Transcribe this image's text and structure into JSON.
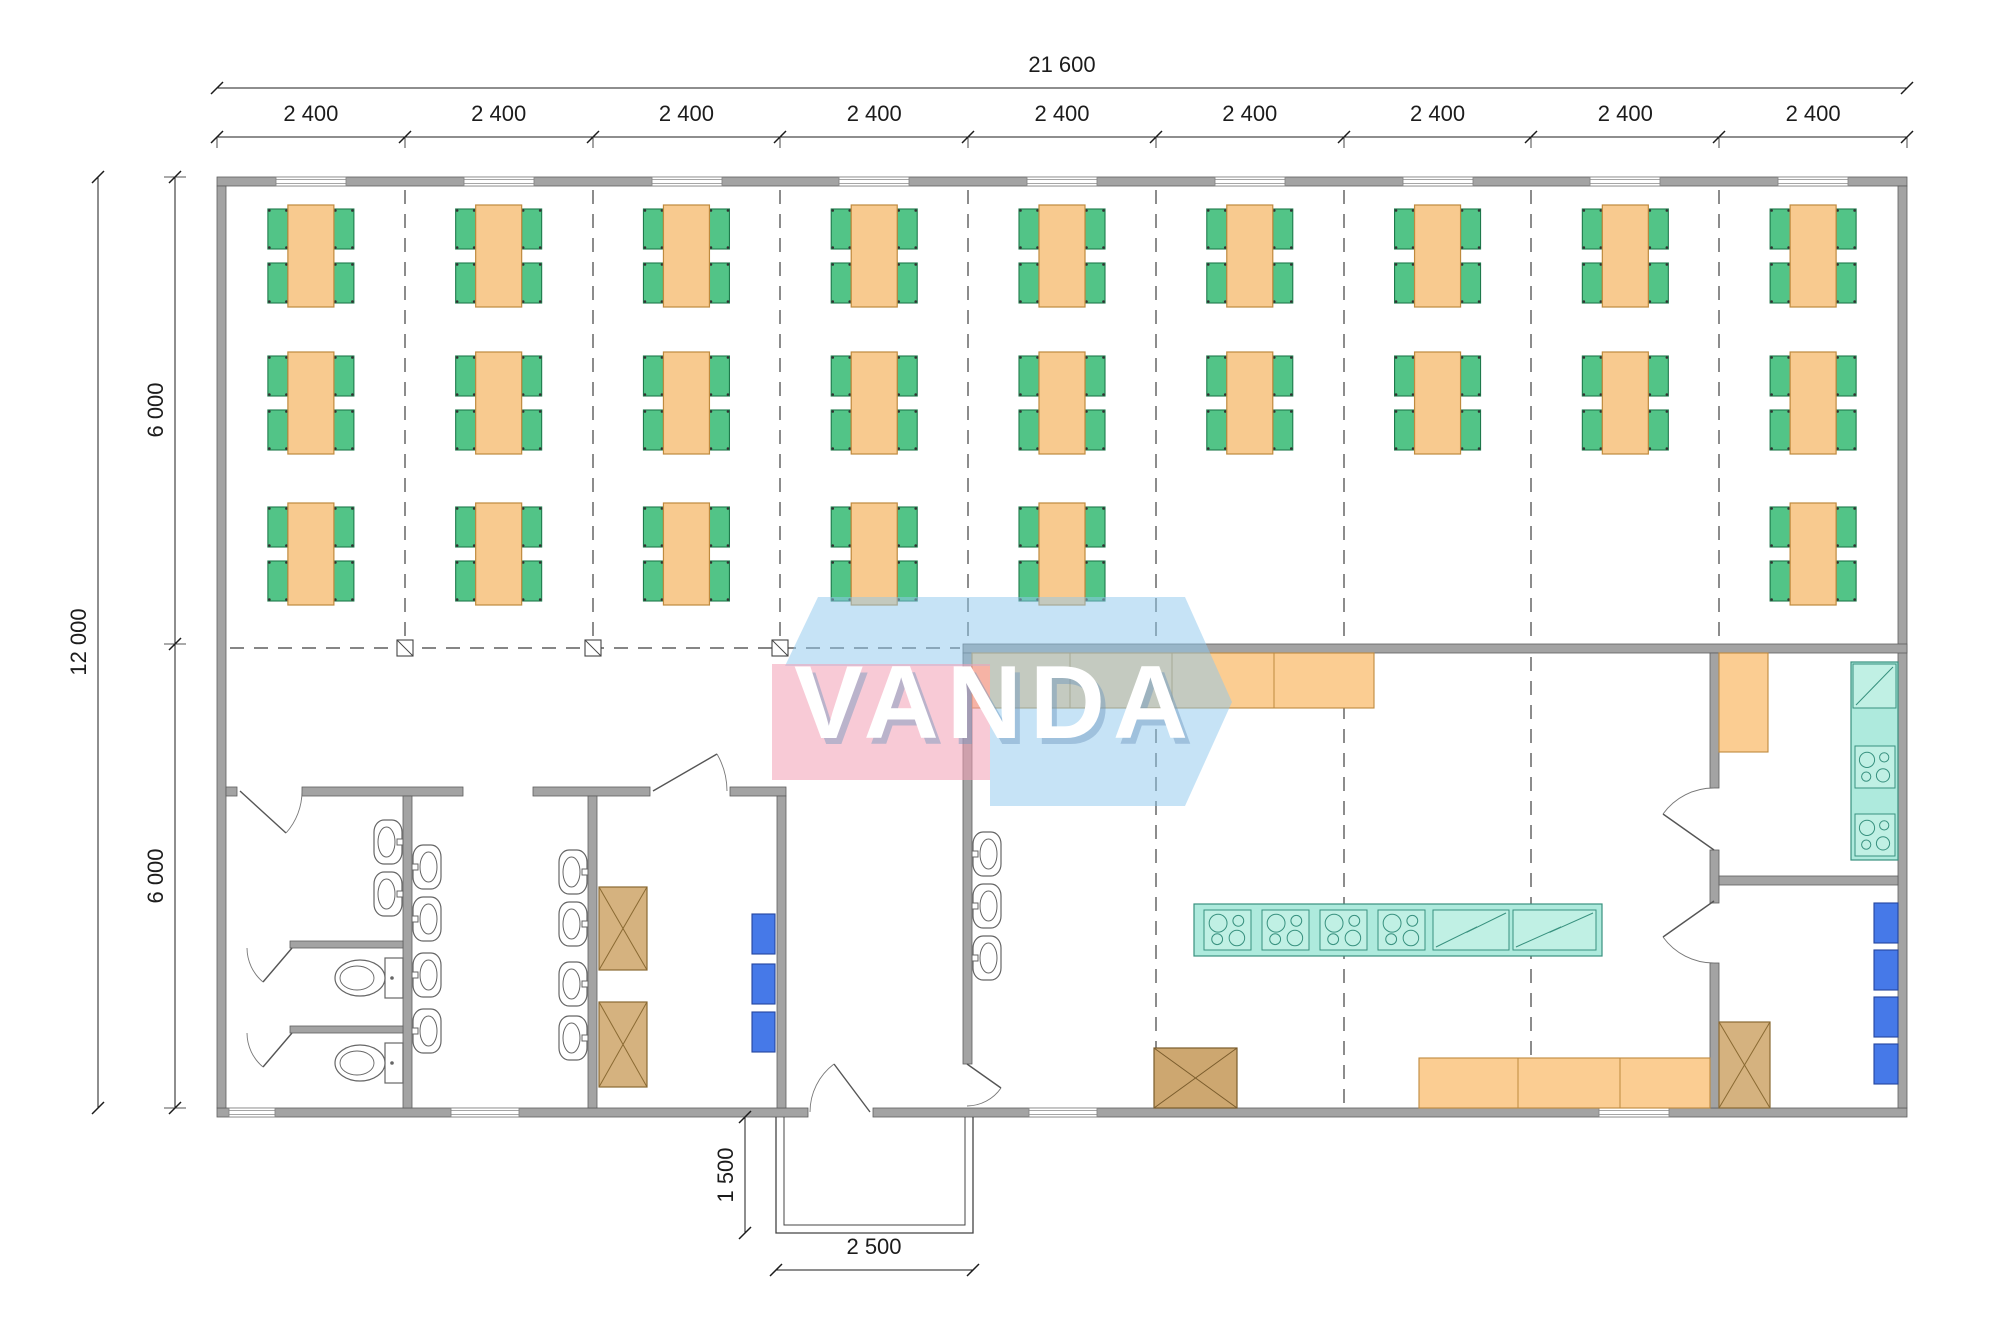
{
  "watermark": {
    "text": "VANDA",
    "pink": "rgba(242,158,180,0.55)",
    "blue": "rgba(141,200,238,0.50)",
    "text_color": "#ffffff",
    "shadow_color": "rgba(110,150,190,0.45)"
  },
  "labels": {
    "overall_width": "21 600",
    "bay": "2 400",
    "overall_height": "12 000",
    "half_height": "6 000",
    "porch_depth": "1 500",
    "porch_width": "2 500"
  },
  "colors": {
    "wall_fill": "#a3a3a3",
    "wall_edge": "#5e5e5e",
    "dim": "#1c1c1c",
    "dash": "#3f3f3f",
    "table_fill": "#f8ca8f",
    "table_edge": "#bf8a3e",
    "chair_fill": "#52c487",
    "chair_edge": "#1e7a4c",
    "counter_fill": "#fbcd92",
    "counter_edge": "#bf8a3e",
    "teal_fill": "#aeeadd",
    "teal_unit": "#c0f0e4",
    "teal_edge": "#38917f",
    "tan_fill": "#d5b27f",
    "tan_edge": "#8a6a33",
    "brown_fill": "#cda770",
    "brown_edge": "#7a5c2c",
    "blue_fill": "#4679e8",
    "blue_edge": "#24459e",
    "fixture_edge": "#666666",
    "porch_edge": "#444444",
    "window_edge": "#888888"
  },
  "geometry": {
    "bounds": {
      "x1": 217,
      "y1": 177,
      "x2": 1907,
      "y2": 1117
    },
    "bay_count": 9,
    "walls": [
      [
        217,
        177,
        1690,
        9
      ],
      [
        217,
        1108,
        591,
        9
      ],
      [
        873,
        1108,
        1034,
        9
      ],
      [
        217,
        186,
        9,
        922
      ],
      [
        1898,
        186,
        9,
        922
      ],
      [
        963,
        644,
        944,
        9
      ],
      [
        226,
        787,
        11,
        9
      ],
      [
        302,
        787,
        161,
        9
      ],
      [
        533,
        787,
        117,
        9
      ],
      [
        730,
        787,
        56,
        9
      ],
      [
        403,
        796,
        9,
        312
      ],
      [
        588,
        796,
        9,
        312
      ],
      [
        777,
        796,
        9,
        312
      ],
      [
        963,
        653,
        9,
        411
      ],
      [
        1710,
        653,
        9,
        135
      ],
      [
        1710,
        850,
        9,
        53
      ],
      [
        1710,
        963,
        9,
        145
      ],
      [
        1719,
        876,
        179,
        9
      ],
      [
        290,
        941,
        113,
        7
      ],
      [
        290,
        1026,
        113,
        7
      ]
    ],
    "windows_top": {
      "y": 177,
      "h": 9,
      "w": 70,
      "centers": [
        311,
        499,
        687,
        874,
        1062,
        1250,
        1438,
        1625,
        1813
      ]
    },
    "windows_bottom": {
      "y": 1108,
      "h": 9,
      "items": [
        [
          229,
          46
        ],
        [
          451,
          68
        ],
        [
          1029,
          68
        ],
        [
          1599,
          70
        ]
      ]
    },
    "doors": [
      {
        "h": [
          240,
          791
        ],
        "t": [
          286,
          833
        ],
        "a": [
          302,
          791
        ],
        "sweep": 0
      },
      {
        "h": [
          653,
          791
        ],
        "t": [
          717,
          754
        ],
        "a": [
          727,
          791
        ],
        "sweep": 1
      },
      {
        "h": [
          870,
          1112
        ],
        "t": [
          834,
          1064
        ],
        "a": [
          810,
          1112
        ],
        "sweep": 0
      },
      {
        "h": [
          967,
          1064
        ],
        "t": [
          1001,
          1088
        ],
        "a": [
          967,
          1106
        ],
        "sweep": 1
      },
      {
        "h": [
          1714,
          850
        ],
        "t": [
          1663,
          814
        ],
        "a": [
          1714,
          788
        ],
        "sweep": 1
      },
      {
        "h": [
          1714,
          901
        ],
        "t": [
          1663,
          937
        ],
        "a": [
          1714,
          963
        ],
        "sweep": 0
      },
      {
        "h": [
          292,
          948
        ],
        "t": [
          263,
          982
        ],
        "a": [
          247,
          948
        ],
        "sweep": 1
      },
      {
        "h": [
          292,
          1033
        ],
        "t": [
          263,
          1067
        ],
        "a": [
          247,
          1033
        ],
        "sweep": 1
      }
    ],
    "dash_v": [
      {
        "x": 405,
        "y1": 190,
        "y2": 640
      },
      {
        "x": 593,
        "y1": 190,
        "y2": 640
      },
      {
        "x": 780,
        "y1": 190,
        "y2": 640
      },
      {
        "x": 968,
        "y1": 190,
        "y2": 640
      },
      {
        "x": 1156,
        "y1": 190,
        "y2": 640
      },
      {
        "x": 1344,
        "y1": 190,
        "y2": 640
      },
      {
        "x": 1531,
        "y1": 190,
        "y2": 640
      },
      {
        "x": 1719,
        "y1": 190,
        "y2": 640
      },
      {
        "x": 1156,
        "y1": 657,
        "y2": 1104
      },
      {
        "x": 1344,
        "y1": 657,
        "y2": 1104
      },
      {
        "x": 1531,
        "y1": 657,
        "y2": 1104
      }
    ],
    "dash_h": [
      {
        "y": 648,
        "x1": 230,
        "x2": 960
      }
    ],
    "columns": [
      [
        405,
        648
      ],
      [
        593,
        648
      ],
      [
        780,
        648
      ]
    ],
    "tables": {
      "row_y": [
        205,
        352,
        503
      ],
      "rows": [
        [
          1,
          2,
          3,
          4,
          5,
          6,
          7,
          8,
          9
        ],
        [
          1,
          2,
          3,
          4,
          5,
          6,
          7,
          8,
          9
        ],
        [
          1,
          2,
          3,
          4,
          5,
          9
        ]
      ],
      "w": 46,
      "h": 102,
      "chair_w": 20,
      "chair_h": 40
    },
    "counters_orange": [
      {
        "x": 972,
        "y": 653,
        "w": 402,
        "h": 55,
        "div": [
          1070,
          1172,
          1274
        ]
      },
      {
        "x": 1419,
        "y": 1058,
        "w": 291,
        "h": 50,
        "div": [
          1518,
          1620
        ]
      },
      {
        "x": 1719,
        "y": 653,
        "w": 49,
        "h": 99,
        "div": []
      }
    ],
    "island": {
      "x": 1194,
      "y": 904,
      "w": 408,
      "h": 52,
      "cooktops": [
        [
          1204,
          910,
          47,
          40
        ],
        [
          1262,
          910,
          47,
          40
        ],
        [
          1320,
          910,
          47,
          40
        ],
        [
          1378,
          910,
          47,
          40
        ]
      ],
      "slashes": [
        [
          1433,
          910,
          76,
          40
        ],
        [
          1513,
          910,
          83,
          40
        ]
      ]
    },
    "right_counter": {
      "x": 1851,
      "y": 662,
      "w": 47,
      "h": 198,
      "cooktops": [
        [
          1855,
          746,
          40,
          42
        ],
        [
          1855,
          814,
          40,
          42
        ]
      ],
      "slashes": [
        [
          1853,
          664,
          43,
          44
        ]
      ]
    },
    "xboxes": [
      {
        "x": 599,
        "y": 887,
        "w": 48,
        "h": 83,
        "c": "tan"
      },
      {
        "x": 599,
        "y": 1002,
        "w": 48,
        "h": 85,
        "c": "tan"
      },
      {
        "x": 1154,
        "y": 1048,
        "w": 83,
        "h": 60,
        "c": "brown"
      },
      {
        "x": 1719,
        "y": 1022,
        "w": 51,
        "h": 86,
        "c": "tan"
      }
    ],
    "bboxes": [
      [
        752,
        914,
        23,
        40
      ],
      [
        752,
        964,
        23,
        40
      ],
      [
        752,
        1012,
        23,
        40
      ],
      [
        1874,
        903,
        24,
        40
      ],
      [
        1874,
        950,
        24,
        40
      ],
      [
        1874,
        997,
        24,
        40
      ],
      [
        1874,
        1044,
        24,
        40
      ]
    ],
    "sinks": [
      {
        "x": 403,
        "y": 820,
        "d": -1
      },
      {
        "x": 403,
        "y": 872,
        "d": -1
      },
      {
        "x": 412,
        "y": 845,
        "d": 1
      },
      {
        "x": 412,
        "y": 897,
        "d": 1
      },
      {
        "x": 412,
        "y": 953,
        "d": 1
      },
      {
        "x": 412,
        "y": 1009,
        "d": 1
      },
      {
        "x": 588,
        "y": 850,
        "d": -1
      },
      {
        "x": 588,
        "y": 902,
        "d": -1
      },
      {
        "x": 588,
        "y": 962,
        "d": -1
      },
      {
        "x": 588,
        "y": 1016,
        "d": -1
      },
      {
        "x": 972,
        "y": 832,
        "d": 1
      },
      {
        "x": 972,
        "y": 884,
        "d": 1
      },
      {
        "x": 972,
        "y": 936,
        "d": 1
      }
    ],
    "toilets": [
      {
        "y": 958
      },
      {
        "y": 1043
      }
    ],
    "porch": {
      "outer": [
        776,
        1117,
        197,
        116
      ],
      "inset": 8
    },
    "dims": {
      "top1": {
        "y": 88,
        "x1": 217,
        "x2": 1907,
        "label_x": 1062,
        "label_y": 72
      },
      "top2": {
        "y": 137,
        "ticks": [
          217,
          405,
          593,
          780,
          968,
          1156,
          1344,
          1531,
          1719,
          1907
        ],
        "label_y": 121
      },
      "left1": {
        "x": 98,
        "y1": 177,
        "y2": 1108,
        "label_x": 86,
        "label_y": 642
      },
      "left2": {
        "x": 175,
        "ticks": [
          177,
          644,
          1108
        ],
        "labels_y": [
          410,
          876
        ],
        "label_x": 163
      },
      "porch_v": {
        "x": 745,
        "y1": 1117,
        "y2": 1233,
        "label_x": 733,
        "label_y": 1175
      },
      "porch_h": {
        "y": 1270,
        "x1": 776,
        "x2": 973,
        "label_x": 874,
        "label_y": 1254
      }
    }
  }
}
